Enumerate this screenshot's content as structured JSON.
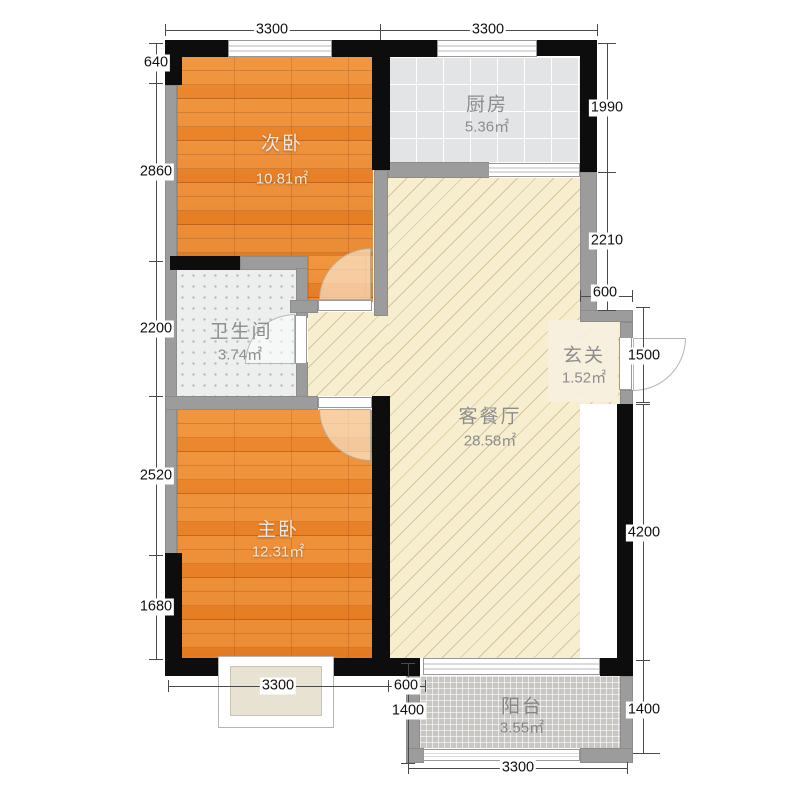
{
  "rooms": {
    "secondary_bedroom": {
      "name": "次卧",
      "area": "10.81㎡"
    },
    "kitchen": {
      "name": "厨房",
      "area": "5.36㎡"
    },
    "bathroom": {
      "name": "卫生间",
      "area": "3.74㎡"
    },
    "living_dining": {
      "name": "客餐厅",
      "area": "28.58㎡"
    },
    "entry": {
      "name": "玄关",
      "area": "1.52㎡"
    },
    "master_bedroom": {
      "name": "主卧",
      "area": "12.31㎡"
    },
    "balcony": {
      "name": "阳台",
      "area": "3.55㎡"
    }
  },
  "dimensions": {
    "top": [
      "3300",
      "3300"
    ],
    "left": [
      "640",
      "2860",
      "2200",
      "2520",
      "1680"
    ],
    "right_upper": [
      "1990",
      "2210"
    ],
    "entry_width": "600",
    "entry_door": "1500",
    "right_lower": [
      "4200",
      "1400"
    ],
    "bottom_master": "3300",
    "bottom_gap": "600",
    "balcony_left": "1400",
    "balcony_bottom": "3300"
  },
  "colors": {
    "exterior_wall": "#0d0d0d",
    "interior_wall": "#9c9c9c",
    "wood_floor": "#e8812a",
    "living_floor": "#f6eecf",
    "kitchen_tile": "#e2e4e6",
    "bathroom_tile": "#edefef",
    "balcony_tile": "#c8c6c3"
  }
}
